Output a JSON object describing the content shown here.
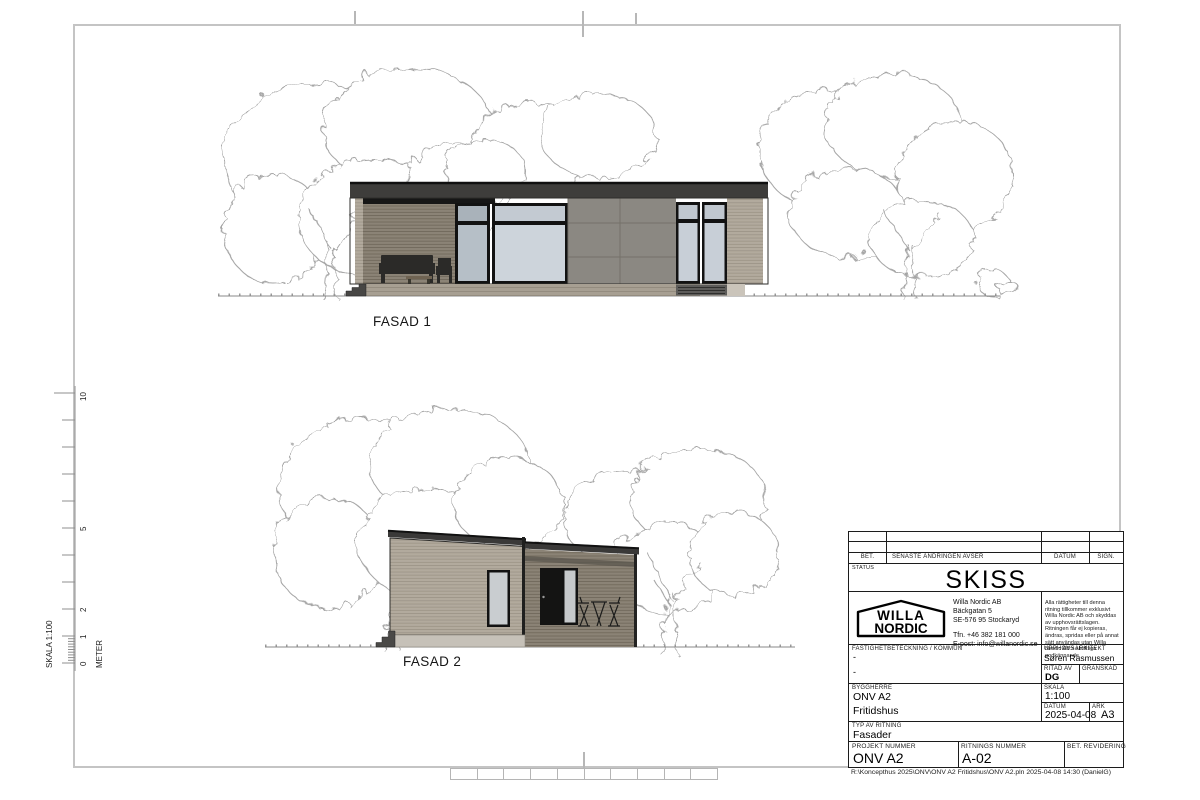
{
  "sheet": {
    "footer": "R:\\Koncepthus 2025\\ONV\\ONV A2 Fritidshus\\ONV A2.pln    2025-04-08  14:30   (DanielG)"
  },
  "drawings": {
    "fasad1_label": "FASAD 1",
    "fasad2_label": "FASAD 2"
  },
  "scale_ruler": {
    "title": "SKALA 1:100",
    "unit": "METER",
    "m0": "0",
    "m1": "1",
    "m2": "2",
    "m5": "5",
    "m10": "10"
  },
  "title_block": {
    "revision_header": {
      "bet": "BET.",
      "change": "SENASTE ÄNDRINGEN AVSER",
      "datum": "DATUM",
      "sign": "SIGN."
    },
    "status_label": "STATUS",
    "status_value": "SKISS",
    "company": {
      "logo_line1": "WILLA",
      "logo_line2": "NORDIC",
      "name": "Willa Nordic AB",
      "address1": "Bäckgatan 5",
      "address2": "SE-576 95  Stockaryd",
      "phone": "Tfn. +46 382 181 000",
      "email": "E-post:  info@willanordic.se",
      "copyright": "Alla rättigheter till denna ritning tillkommer exklusivt Willa Nordic AB och skyddas av upphovsrättslagen. Ritningen får ej kopieras, ändras, spridas eller på annat sätt användas utan Willa Nordic AB:s skriftliga godkännande."
    },
    "fields": {
      "fastighet_label": "FASTIGHETBETECKNING / KOMMUN",
      "fastighet_value1": "-",
      "fastighet_value2": "-",
      "upphovsarkitekt_label": "UPPHOVSARKITEKT",
      "upphovsarkitekt_value": "Søren Rasmussen",
      "ritad_av_label": "RITAD AV",
      "ritad_av_value": "DG",
      "granskad_label": "GRANSKAD",
      "byggherre_label": "BYGGHERRE",
      "byggherre_value1": "ONV A2",
      "byggherre_value2": "Fritidshus",
      "skala_label": "SKALA",
      "skala_value": "1:100",
      "datum_label": "DATUM",
      "datum_value": "2025-04-08",
      "ark_label": "ARK",
      "ark_value": "A3",
      "typ_label": "TYP AV RITNING",
      "typ_value": "Fasader",
      "projekt_label": "PROJEKT  NUMMER",
      "projekt_value": "ONV A2",
      "ritningsnummer_label": "RITNINGS NUMMER",
      "ritningsnummer_value": "A-02",
      "bet_revidering_label": "BET. REVIDERING"
    }
  },
  "colors": {
    "roof": "#3c3b39",
    "siding_light": "#b2aa9d",
    "siding_porch": "#8b8376",
    "panel_gray": "#8b8882",
    "glazing": "#ccd3da",
    "frame_black": "#121212",
    "foundation": "#a79f92",
    "tree_outline": "#a3a3a3"
  }
}
